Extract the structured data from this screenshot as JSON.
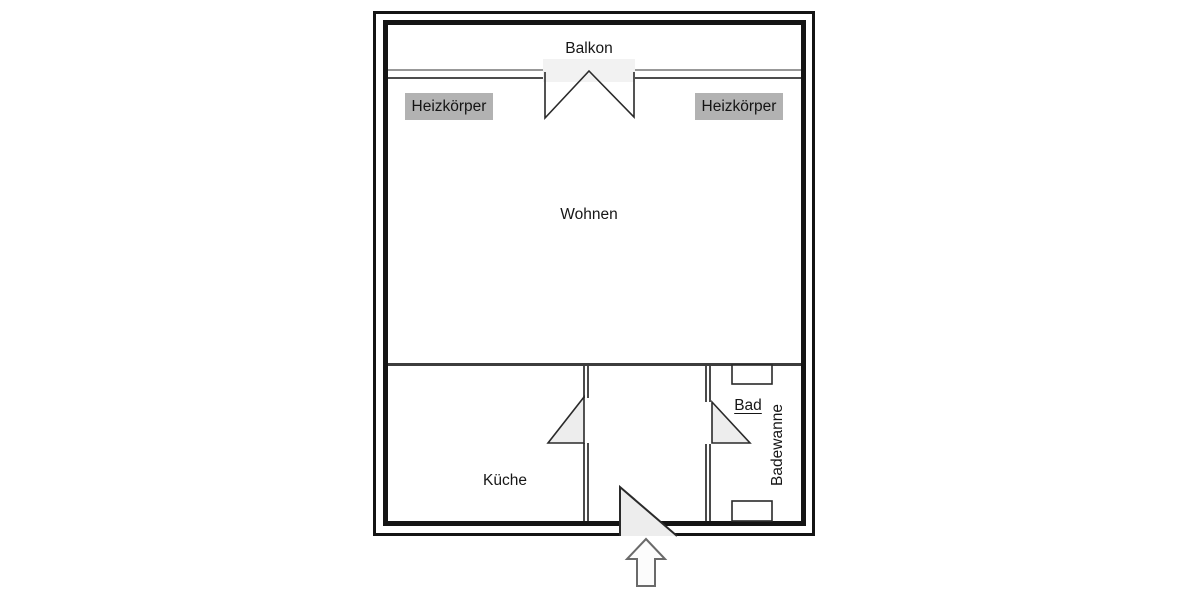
{
  "floorplan": {
    "labels": {
      "balcony": "Balkon",
      "radiator": "Heizkörper",
      "living": "Wohnen",
      "kitchen": "Küche",
      "bath": "Bad",
      "bathtub": "Badewanne"
    },
    "colors": {
      "wall": "#141414",
      "partition_wall": "#4a4a4a",
      "window_line_light": "#989898",
      "window_line_dark": "#4d4d4d",
      "radiator_box_bg": "#b2b2b2",
      "door_swing_fill": "#ededed",
      "door_swing_stroke": "#2a2a2a",
      "balcony_opening_fill": "#f2f2f2",
      "arrow_outline": "#6a6a6a",
      "background": "#ffffff",
      "text": "#161616"
    }
  }
}
